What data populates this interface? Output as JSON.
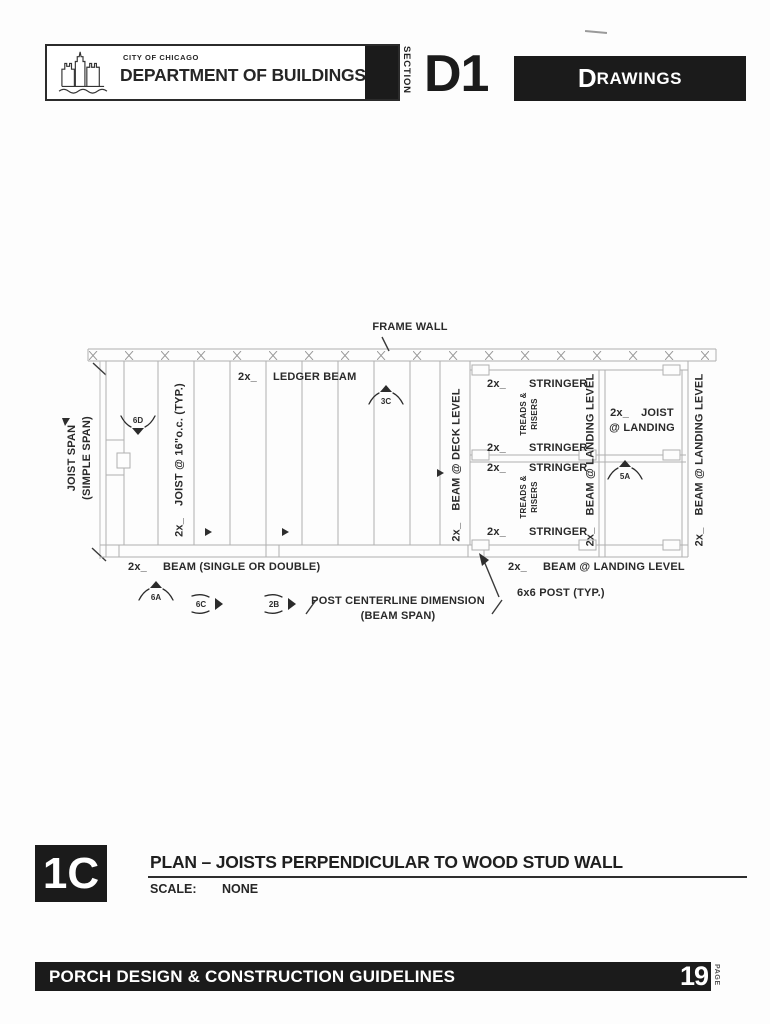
{
  "colors": {
    "banner_bg": "#1b1b1b",
    "banner_text": "#ffffff",
    "ink": "#262626",
    "linework": "#b0b0b0"
  },
  "header": {
    "city_small": "CITY OF CHICAGO",
    "department": "DEPARTMENT OF BUILDINGS",
    "section_label": "SECTION",
    "section_code": "D1",
    "drawings_initial": "D",
    "drawings_rest": "RAWINGS"
  },
  "drawing": {
    "frame_wall": "FRAME WALL",
    "ledger": {
      "prefix": "2x_",
      "label": "LEDGER BEAM"
    },
    "joist_span": {
      "line1": "JOIST SPAN",
      "line2": "(SIMPLE SPAN)"
    },
    "joist_typ": {
      "prefix": "2x_",
      "label": "JOIST @ 16\"o.c. (TYP.)"
    },
    "beam_deck": {
      "prefix": "2x_",
      "label": "BEAM @ DECK LEVEL"
    },
    "stringers": [
      {
        "prefix": "2x_",
        "label": "STRINGER"
      },
      {
        "prefix": "2x_",
        "label": "STRINGER"
      },
      {
        "prefix": "2x_",
        "label": "STRINGER"
      },
      {
        "prefix": "2x_",
        "label": "STRINGER"
      }
    ],
    "treads": [
      {
        "line1": "TREADS &",
        "line2": "RISERS"
      },
      {
        "line1": "TREADS &",
        "line2": "RISERS"
      }
    ],
    "beam_landing_mid": {
      "prefix": "2x_",
      "label": "BEAM @ LANDING LEVEL"
    },
    "joist_landing": {
      "prefix": "2x_",
      "label": "JOIST",
      "line2": "@ LANDING"
    },
    "beam_landing_right": {
      "prefix": "2x_",
      "label": "BEAM @ LANDING LEVEL"
    },
    "beam_single": {
      "prefix": "2x_",
      "label": "BEAM (SINGLE OR DOUBLE)"
    },
    "post_dim": {
      "line1": "POST CENTERLINE DIMENSION",
      "line2": "(BEAM SPAN)"
    },
    "beam_landing_bottom": {
      "prefix": "2x_",
      "label": "BEAM @ LANDING LEVEL"
    },
    "post_typ": "6x6 POST (TYP.)",
    "markers": {
      "d6": "6D",
      "c3": "3C",
      "a5": "5A",
      "a6": "6A",
      "c6": "6C",
      "b2": "2B"
    }
  },
  "titleblock": {
    "detail_code": "1C",
    "title": "PLAN – JOISTS PERPENDICULAR TO WOOD STUD WALL",
    "scale_label": "SCALE:",
    "scale_value": "NONE"
  },
  "footer": {
    "title": "PORCH DESIGN & CONSTRUCTION GUIDELINES",
    "page_number": "19",
    "page_label": "PAGE"
  }
}
